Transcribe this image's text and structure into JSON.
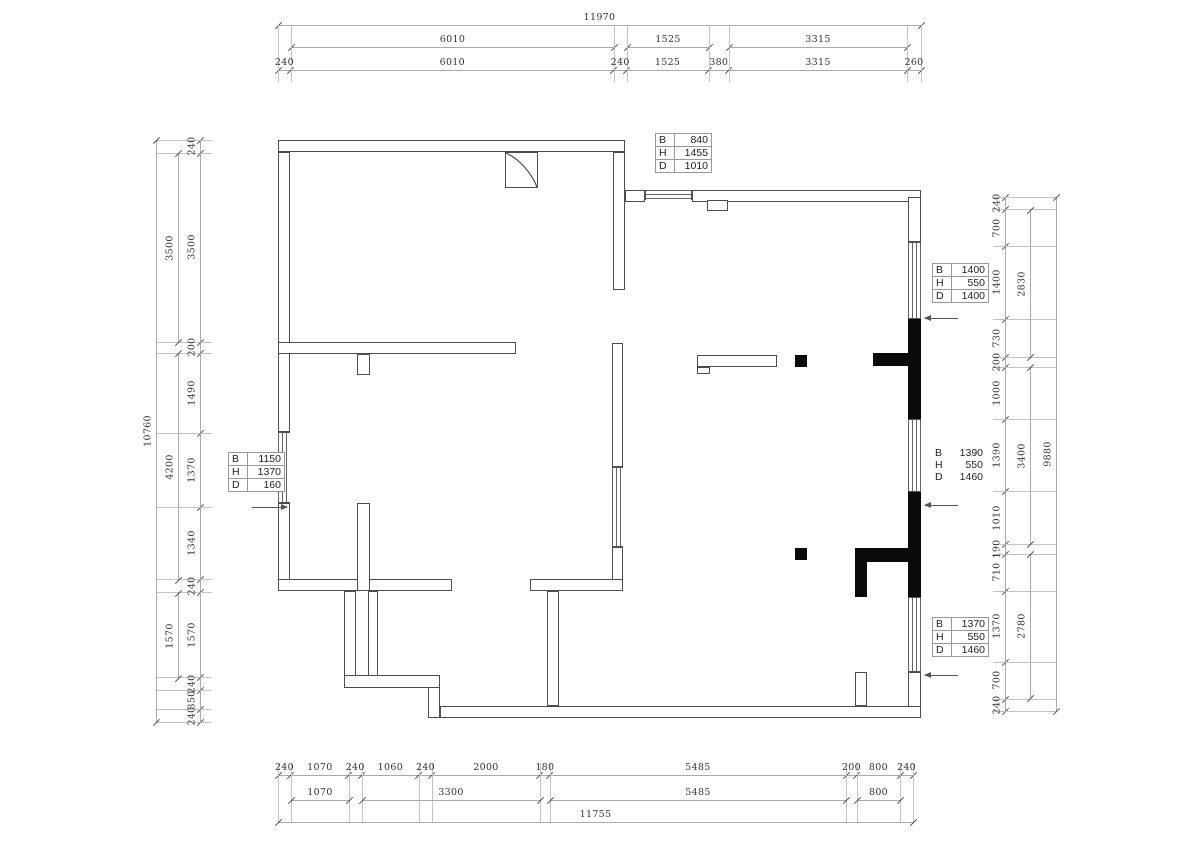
{
  "page": {
    "width": 1200,
    "height": 848,
    "background": "#ffffff"
  },
  "colors": {
    "wall_line": "#4d4d4d",
    "solid_fill": "#0a0a0a",
    "dim_line": "#aaaaaa",
    "dim_text": "#333333",
    "table_border": "#999999"
  },
  "dim_chains": [
    {
      "name": "top-total",
      "dir": "h",
      "line": 25,
      "from": 278,
      "to": 921,
      "values": [
        11970
      ]
    },
    {
      "name": "top-group-6010",
      "dir": "h",
      "line": 47,
      "from": 291,
      "to": 614,
      "values": [
        6010
      ]
    },
    {
      "name": "top-group-1525",
      "dir": "h",
      "line": 47,
      "from": 627,
      "to": 709,
      "values": [
        1525
      ]
    },
    {
      "name": "top-group-3315",
      "dir": "h",
      "line": 47,
      "from": 729,
      "to": 907,
      "values": [
        3315
      ]
    },
    {
      "name": "top-detail",
      "dir": "h",
      "line": 70,
      "from": 278,
      "to": 921,
      "ext": 25,
      "values": [
        240,
        6010,
        240,
        1525,
        380,
        3315,
        260
      ]
    },
    {
      "name": "bottom-detail",
      "dir": "h",
      "line": 775,
      "from": 278,
      "to": 913,
      "ext": 822,
      "values": [
        240,
        1070,
        240,
        1060,
        240,
        2000,
        180,
        5485,
        200,
        800,
        240
      ]
    },
    {
      "name": "bottom-group-1070",
      "dir": "h",
      "line": 800,
      "from": 291,
      "to": 349,
      "values": [
        1070
      ]
    },
    {
      "name": "bottom-group-3300",
      "dir": "h",
      "line": 800,
      "from": 362,
      "to": 540,
      "values": [
        3300
      ]
    },
    {
      "name": "bottom-group-5485",
      "dir": "h",
      "line": 800,
      "from": 550,
      "to": 846,
      "values": [
        5485
      ]
    },
    {
      "name": "bottom-group-800",
      "dir": "h",
      "line": 800,
      "from": 857,
      "to": 900,
      "values": [
        800
      ]
    },
    {
      "name": "bottom-total",
      "dir": "h",
      "line": 822,
      "from": 278,
      "to": 913,
      "values": [
        11755
      ]
    },
    {
      "name": "left-detail",
      "dir": "v",
      "line": 200,
      "from": 140,
      "to": 722,
      "ext": 156,
      "values": [
        240,
        3500,
        200,
        1490,
        1370,
        1340,
        240,
        1570,
        240,
        350,
        240
      ]
    },
    {
      "name": "left-group-3500",
      "dir": "v",
      "line": 178,
      "from": 153,
      "to": 342,
      "values": [
        3500
      ]
    },
    {
      "name": "left-group-4200",
      "dir": "v",
      "line": 178,
      "from": 353,
      "to": 580,
      "values": [
        4200
      ]
    },
    {
      "name": "left-group-1570",
      "dir": "v",
      "line": 178,
      "from": 593,
      "to": 678,
      "values": [
        1570
      ]
    },
    {
      "name": "left-total",
      "dir": "v",
      "line": 156,
      "from": 140,
      "to": 722,
      "values": [
        10760
      ]
    },
    {
      "name": "right-detail",
      "dir": "v",
      "line": 1005,
      "from": 197,
      "to": 711,
      "ext": 1056,
      "values": [
        240,
        700,
        1400,
        730,
        200,
        1000,
        1390,
        1010,
        190,
        710,
        1370,
        700,
        240
      ]
    },
    {
      "name": "right-group-2830",
      "dir": "v",
      "line": 1030,
      "from": 210,
      "to": 357,
      "values": [
        2830
      ]
    },
    {
      "name": "right-group-3400",
      "dir": "v",
      "line": 1030,
      "from": 367,
      "to": 544,
      "values": [
        3400
      ]
    },
    {
      "name": "right-group-2780",
      "dir": "v",
      "line": 1030,
      "from": 554,
      "to": 698,
      "values": [
        2780
      ]
    },
    {
      "name": "right-total",
      "dir": "v",
      "line": 1056,
      "from": 197,
      "to": 711,
      "values": [
        9880
      ]
    }
  ],
  "tables": [
    {
      "name": "opening-top",
      "x": 655,
      "y": 133,
      "bordered": true,
      "rows": [
        [
          "B",
          "840"
        ],
        [
          "H",
          "1455"
        ],
        [
          "D",
          "1010"
        ]
      ]
    },
    {
      "name": "opening-right-1400",
      "x": 932,
      "y": 263,
      "bordered": true,
      "rows": [
        [
          "B",
          "1400"
        ],
        [
          "H",
          "550"
        ],
        [
          "D",
          "1400"
        ]
      ]
    },
    {
      "name": "opening-left-1150",
      "x": 228,
      "y": 452,
      "bordered": true,
      "rows": [
        [
          "B",
          "1150"
        ],
        [
          "H",
          "1370"
        ],
        [
          "D",
          "160"
        ]
      ]
    },
    {
      "name": "opening-right-1390",
      "x": 932,
      "y": 447,
      "bordered": false,
      "rows": [
        [
          "B",
          "1390"
        ],
        [
          "H",
          "550"
        ],
        [
          "D",
          "1460"
        ]
      ]
    },
    {
      "name": "opening-right-1370",
      "x": 932,
      "y": 617,
      "bordered": true,
      "rows": [
        [
          "B",
          "1370"
        ],
        [
          "H",
          "550"
        ],
        [
          "D",
          "1460"
        ]
      ]
    }
  ],
  "leaders": [
    {
      "name": "leader-right-1400",
      "x1": 925,
      "x2": 958,
      "y": 318,
      "arrow": "left"
    },
    {
      "name": "leader-right-1390",
      "x1": 925,
      "x2": 958,
      "y": 505,
      "arrow": "left"
    },
    {
      "name": "leader-right-1370",
      "x1": 925,
      "x2": 958,
      "y": 675,
      "arrow": "left"
    },
    {
      "name": "leader-left-1150",
      "x1": 252,
      "x2": 287,
      "y": 507,
      "arrow": "right"
    }
  ],
  "walls": [
    {
      "n": "wall-topleft-room-top",
      "t": "o",
      "x": 278,
      "y": 140,
      "w": 347,
      "h": 12
    },
    {
      "n": "wall-left-upper",
      "t": "o",
      "x": 278,
      "y": 152,
      "w": 12,
      "h": 280
    },
    {
      "n": "window-left-1150",
      "t": "wv",
      "x": 278,
      "y": 432,
      "w": 12,
      "h": 71
    },
    {
      "n": "wall-left-lower",
      "t": "o",
      "x": 278,
      "y": 503,
      "w": 12,
      "h": 88
    },
    {
      "n": "wall-topleft-room-bottom",
      "t": "o",
      "x": 278,
      "y": 342,
      "w": 238,
      "h": 12
    },
    {
      "n": "wall-stub-below",
      "t": "o",
      "x": 357,
      "y": 354,
      "w": 13,
      "h": 21
    },
    {
      "n": "wall-topleft-room-right",
      "t": "o",
      "x": 613,
      "y": 152,
      "w": 12,
      "h": 138
    },
    {
      "n": "wall-top-connector",
      "t": "o",
      "x": 625,
      "y": 190,
      "w": 20,
      "h": 12
    },
    {
      "n": "window-top-840",
      "t": "wh",
      "x": 645,
      "y": 190,
      "w": 47,
      "h": 10
    },
    {
      "n": "wall-topright-top",
      "t": "o",
      "x": 692,
      "y": 190,
      "w": 229,
      "h": 12
    },
    {
      "n": "wall-top-notch",
      "t": "o",
      "x": 707,
      "y": 200,
      "w": 21,
      "h": 11
    },
    {
      "n": "wall-right-top",
      "t": "o",
      "x": 908,
      "y": 197,
      "w": 13,
      "h": 45
    },
    {
      "n": "window-right-1400",
      "t": "wv",
      "x": 908,
      "y": 242,
      "w": 13,
      "h": 77
    },
    {
      "n": "column-right-upper",
      "t": "s",
      "x": 908,
      "y": 319,
      "w": 13,
      "h": 100
    },
    {
      "n": "column-tee-upper",
      "t": "s",
      "x": 873,
      "y": 353,
      "w": 35,
      "h": 13
    },
    {
      "n": "window-right-1390",
      "t": "wv",
      "x": 908,
      "y": 419,
      "w": 13,
      "h": 73
    },
    {
      "n": "column-right-lower",
      "t": "s",
      "x": 908,
      "y": 492,
      "w": 13,
      "h": 105
    },
    {
      "n": "column-bar-lower",
      "t": "s",
      "x": 855,
      "y": 548,
      "w": 53,
      "h": 14
    },
    {
      "n": "column-stub-lower",
      "t": "s",
      "x": 855,
      "y": 562,
      "w": 12,
      "h": 35
    },
    {
      "n": "window-right-1370",
      "t": "wv",
      "x": 908,
      "y": 597,
      "w": 13,
      "h": 75
    },
    {
      "n": "wall-right-bottom",
      "t": "o",
      "x": 908,
      "y": 672,
      "w": 13,
      "h": 46
    },
    {
      "n": "wall-bottom",
      "t": "o",
      "x": 440,
      "y": 706,
      "w": 481,
      "h": 12
    },
    {
      "n": "wall-stub-bottomright",
      "t": "o",
      "x": 855,
      "y": 672,
      "w": 12,
      "h": 34
    },
    {
      "n": "wall-interior-h-left",
      "t": "o",
      "x": 278,
      "y": 579,
      "w": 174,
      "h": 12
    },
    {
      "n": "wall-cross-vertical",
      "t": "o",
      "x": 357,
      "y": 503,
      "w": 13,
      "h": 88
    },
    {
      "n": "wall-inner-step-v",
      "t": "o",
      "x": 368,
      "y": 591,
      "w": 10,
      "h": 86
    },
    {
      "n": "wall-step-v1",
      "t": "o",
      "x": 344,
      "y": 591,
      "w": 12,
      "h": 96
    },
    {
      "n": "wall-step-h",
      "t": "o",
      "x": 344,
      "y": 675,
      "w": 96,
      "h": 13
    },
    {
      "n": "wall-step-v2",
      "t": "o",
      "x": 428,
      "y": 687,
      "w": 12,
      "h": 31
    },
    {
      "n": "wall-interior-h-right",
      "t": "o",
      "x": 530,
      "y": 579,
      "w": 93,
      "h": 12
    },
    {
      "n": "wall-bottomrooms-divider",
      "t": "o",
      "x": 547,
      "y": 591,
      "w": 12,
      "h": 115
    },
    {
      "n": "wall-interior-window-top",
      "t": "o",
      "x": 612,
      "y": 343,
      "w": 11,
      "h": 124
    },
    {
      "n": "window-interior",
      "t": "wv",
      "x": 612,
      "y": 467,
      "w": 11,
      "h": 80
    },
    {
      "n": "wall-interior-window-bot",
      "t": "o",
      "x": 612,
      "y": 547,
      "w": 11,
      "h": 33
    },
    {
      "n": "flue-box",
      "t": "o",
      "x": 505,
      "y": 152,
      "w": 33,
      "h": 36
    },
    {
      "n": "shelf-outline",
      "t": "o",
      "x": 697,
      "y": 355,
      "w": 80,
      "h": 12
    },
    {
      "n": "shelf-foot",
      "t": "o",
      "x": 697,
      "y": 367,
      "w": 13,
      "h": 7
    },
    {
      "n": "column-square-upper",
      "t": "s",
      "x": 795,
      "y": 355,
      "w": 12,
      "h": 12
    },
    {
      "n": "column-square-lower",
      "t": "s",
      "x": 795,
      "y": 548,
      "w": 12,
      "h": 12
    }
  ]
}
